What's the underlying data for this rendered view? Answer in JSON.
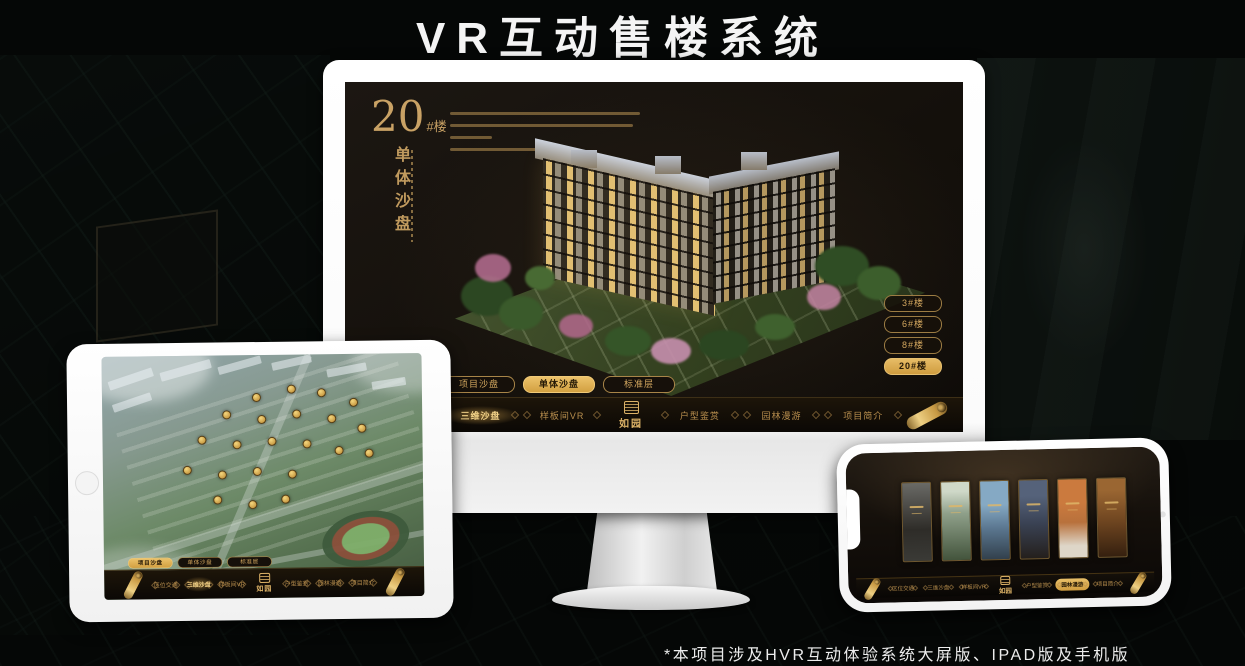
{
  "page": {
    "title": "VR互动售楼系统",
    "footnote": "*本项目涉及HVR互动体验系统大屏版、IPAD版及手机版"
  },
  "colors": {
    "gold": "#c9a265",
    "gold_active": "#e0b35c",
    "screen_bg": "#16110c",
    "device_white": "#ffffff"
  },
  "brand": {
    "logo_text": "如园"
  },
  "nav_items": [
    "区位交通",
    "三维沙盘",
    "样板间VR",
    "户型鉴赏",
    "园林漫游",
    "项目简介"
  ],
  "desktop": {
    "headline_number": "20",
    "headline_suffix": "#楼",
    "vertical_title": "单体沙盘",
    "floor_buttons": [
      {
        "label": "3#楼",
        "active": false
      },
      {
        "label": "6#楼",
        "active": false
      },
      {
        "label": "8#楼",
        "active": false
      },
      {
        "label": "20#楼",
        "active": true
      }
    ],
    "sub_tabs": [
      {
        "label": "项目沙盘",
        "active": false
      },
      {
        "label": "单体沙盘",
        "active": true
      },
      {
        "label": "标准层",
        "active": false
      }
    ],
    "active_nav": "三维沙盘"
  },
  "tablet": {
    "sub_tabs": [
      {
        "label": "项目沙盘",
        "active": true
      },
      {
        "label": "单体沙盘",
        "active": false
      },
      {
        "label": "标准层",
        "active": false
      }
    ],
    "active_nav": "三维沙盘"
  },
  "phone": {
    "active_nav": "园林漫游"
  }
}
